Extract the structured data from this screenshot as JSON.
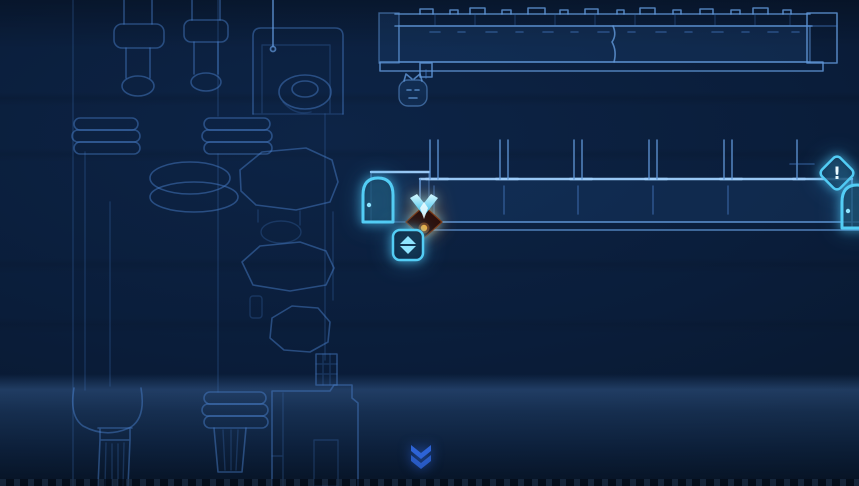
{
  "theme": {
    "bg": "#0a1d3a",
    "bg-deep": "#071527",
    "line-faint": "#1c3e6d",
    "line": "#2c5a96",
    "line-bright": "#4a7fc1",
    "platform-edge": "#9ecdfa",
    "accent": "#53cdf5",
    "accent-soft": "#8ee4ff",
    "alert-text-color": "#ecfbff",
    "chevron": "#2d63d6",
    "char-crest": "#6fe3ff",
    "char-body": "#2c0f0a",
    "char-core": "#ffae33",
    "glow-warm": "#ff8c2a"
  },
  "icons": {
    "door_left": {
      "name": "door-icon"
    },
    "alert": {
      "name": "alert-diamond-icon",
      "label": "!"
    },
    "door_right": {
      "name": "door-icon"
    },
    "lift_button": {
      "name": "lift-button-icon"
    },
    "scroll_down": {
      "name": "scroll-down-icon"
    }
  },
  "player": {
    "name": "player-character"
  }
}
